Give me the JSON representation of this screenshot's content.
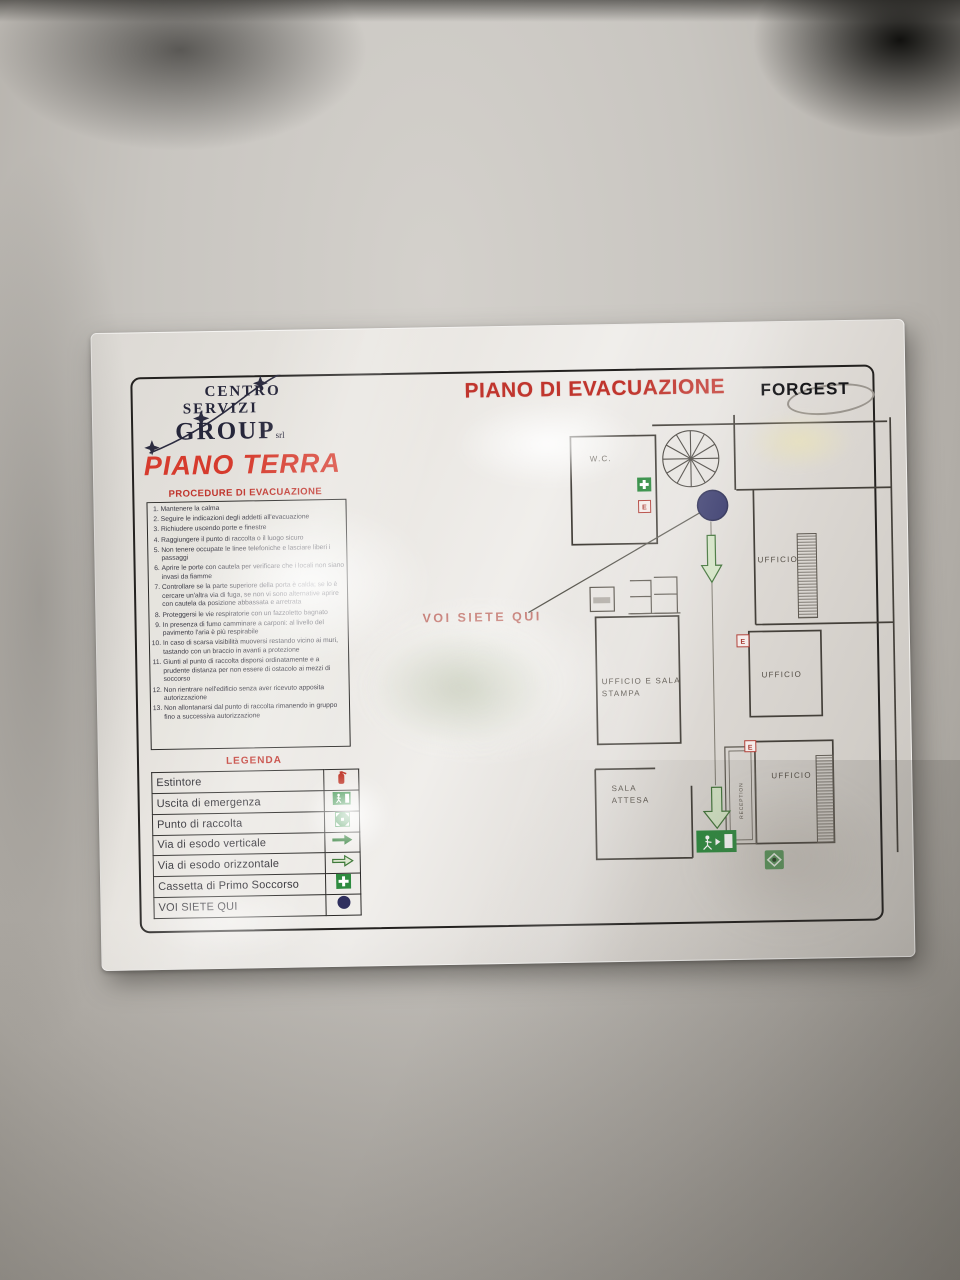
{
  "poster": {
    "title": "PIANO DI EVACUAZIONE",
    "brand": "FORGEST",
    "floor_title": "PIANO TERRA",
    "logo": {
      "line1": "CENTRO",
      "line2": "SERVIZI",
      "line3": "GROUP",
      "suffix": "srl"
    },
    "procedures": {
      "heading": "PROCEDURE DI EVACUAZIONE",
      "items": [
        "Mantenere la calma",
        "Seguire le indicazioni degli addetti all'evacuazione",
        "Richiudere uscendo porte e finestre",
        "Raggiungere il punto di raccolta o il luogo sicuro",
        "Non tenere occupate le linee telefoniche e lasciare liberi i passaggi",
        "Aprire le porte con cautela per verificare che i locali non siano invasi da fiamme",
        "Controllare se la parte superiore della porta è calda; se lo è cercare un'altra via di fuga, se non vi sono alternative aprire con cautela da posizione abbassata e arretrata",
        "Proteggersi le vie respiratorie con un fazzoletto bagnato",
        "In presenza di fumo camminare a carponi: al livello del pavimento l'aria è più respirabile",
        "In caso di scarsa visibilità muoversi restando vicino ai muri, tastando con un braccio in avanti a protezione",
        "Giunti al punto di raccolta disporsi ordinatamente e a prudente distanza per non essere di ostacolo ai mezzi di soccorso",
        "Non rientrare nell'edificio senza aver ricevuto apposita autorizzazione",
        "Non allontanarsi dal punto di raccolta rimanendo in gruppo fino a successiva autorizzazione"
      ]
    },
    "legend": {
      "heading": "LEGENDA",
      "rows": [
        {
          "label": "Estintore",
          "icon": "fire-extinguisher-icon"
        },
        {
          "label": "Uscita di emergenza",
          "icon": "emergency-exit-icon"
        },
        {
          "label": "Punto di raccolta",
          "icon": "assembly-point-icon"
        },
        {
          "label": "Via di esodo verticale",
          "icon": "solid-green-arrow-icon"
        },
        {
          "label": "Via di esodo orizzontale",
          "icon": "outline-green-arrow-icon"
        },
        {
          "label": "Cassetta di Primo Soccorso",
          "icon": "first-aid-cross-icon"
        },
        {
          "label": "VOI SIETE QUI",
          "icon": "you-are-here-dot-icon"
        }
      ]
    },
    "plan": {
      "you_are_here_text": "VOI SIETE QUI",
      "extinguisher_letter": "E",
      "rooms": {
        "wc": "W.C.",
        "office_top_right": "UFFICIO",
        "office_mid_right": "UFFICIO",
        "office_bottom_right": "UFFICIO",
        "press_line1": "UFFICIO E SALA",
        "press_line2": "STAMPA",
        "waiting_line1": "SALA",
        "waiting_line2": "ATTESA",
        "reception": "RECEPTION"
      }
    },
    "colors": {
      "red": "#c0352d",
      "green": "#2e8b40",
      "navy": "#3a3c6e"
    }
  }
}
